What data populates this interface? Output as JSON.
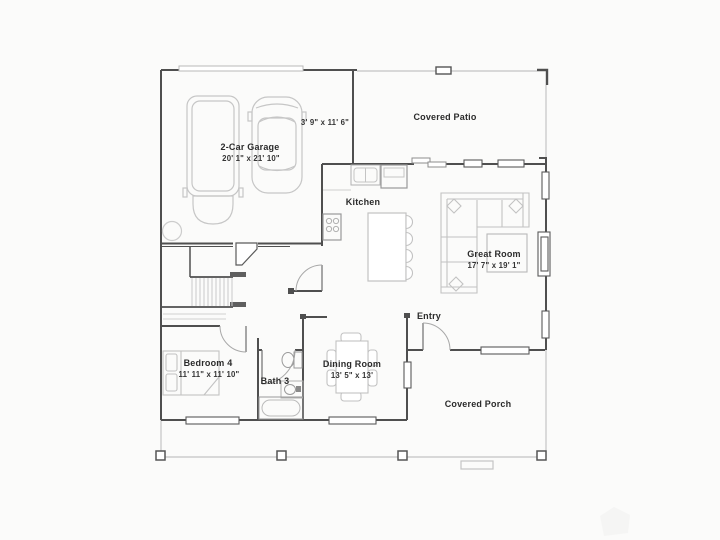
{
  "document": {
    "type": "floor-plan"
  },
  "colors": {
    "background": "#fbfbfa",
    "wall": "#4f4f4f",
    "window_stroke": "#5a5a5a",
    "light_line": "#c4c4c4",
    "furniture_line": "#c2c2c2",
    "fixture_line": "#9a9a9a",
    "text": "#2b2b2b"
  },
  "rooms": {
    "covered_patio": {
      "label": "Covered Patio"
    },
    "garage": {
      "label": "2-Car Garage",
      "dims": "20' 1\" x 21' 10\""
    },
    "garage_storage": {
      "dims": "3' 9\" x 11' 6\""
    },
    "kitchen": {
      "label": "Kitchen"
    },
    "great_room": {
      "label": "Great Room",
      "dims": "17' 7\" x 19' 1\""
    },
    "entry": {
      "label": "Entry"
    },
    "bedroom_4": {
      "label": "Bedroom 4",
      "dims": "11' 11\" x 11' 10\""
    },
    "bath_3": {
      "label": "Bath 3"
    },
    "dining_room": {
      "label": "Dining Room",
      "dims": "13' 5\" x 13'"
    },
    "covered_porch": {
      "label": "Covered Porch"
    }
  }
}
